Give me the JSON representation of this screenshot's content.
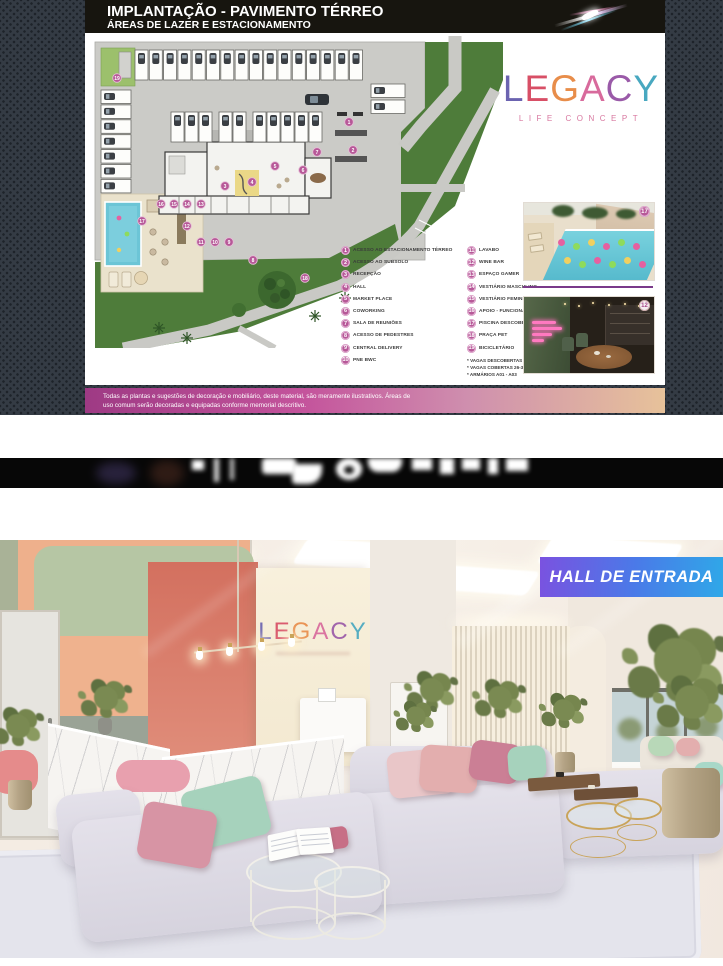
{
  "header": {
    "title_line1": "IMPLANTAÇÃO - PAVIMENTO TÉRREO",
    "title_line2": "ÁREAS DE LAZER E ESTACIONAMENTO"
  },
  "brand": {
    "name": "LEGACY",
    "tagline": "LIFE CONCEPT",
    "letters": [
      {
        "ch": "L",
        "color": "#6b63b0"
      },
      {
        "ch": "E",
        "color": "#d84f66"
      },
      {
        "ch": "G",
        "color": "#e88d4a"
      },
      {
        "ch": "A",
        "color": "#d86a9c"
      },
      {
        "ch": "C",
        "color": "#9a5aa8"
      },
      {
        "ch": "Y",
        "color": "#48a8c0"
      }
    ]
  },
  "legend": {
    "column1": [
      {
        "num": "1",
        "label": "ACESSO AO ESTACIONAMENTO TÉRREO"
      },
      {
        "num": "2",
        "label": "ACESSO AO SUBSOLO"
      },
      {
        "num": "3",
        "label": "RECEPÇÃO"
      },
      {
        "num": "4",
        "label": "HALL"
      },
      {
        "num": "5",
        "label": "MARKET PLACE"
      },
      {
        "num": "6",
        "label": "COWORKING"
      },
      {
        "num": "7",
        "label": "SALA DE REUNIÕES"
      },
      {
        "num": "8",
        "label": "ACESSO DE PEDESTRES"
      },
      {
        "num": "9",
        "label": "CENTRAL DELIVERY"
      },
      {
        "num": "10",
        "label": "PNE BWC"
      }
    ],
    "column2": [
      {
        "num": "11",
        "label": "LAVABO"
      },
      {
        "num": "12",
        "label": "WINE BAR"
      },
      {
        "num": "13",
        "label": "ESPAÇO GAMER"
      },
      {
        "num": "14",
        "label": "VESTIÁRIO MASCULINO"
      },
      {
        "num": "15",
        "label": "VESTIÁRIO FEMININO"
      },
      {
        "num": "16",
        "label": "APOIO - FUNCIONÁRIO"
      },
      {
        "num": "17",
        "label": "PISCINA DESCOBERTA"
      },
      {
        "num": "18",
        "label": "PRAÇA PET"
      },
      {
        "num": "19",
        "label": "BICICLETÁRIO"
      }
    ],
    "footnotes": [
      "* VAGAS DESCOBERTAS 1-25",
      "* VAGAS COBERTAS 26-35",
      "* ARMÁRIOS A01 - A03"
    ]
  },
  "map_badges": [
    {
      "n": "1",
      "x": 260,
      "y": 86
    },
    {
      "n": "2",
      "x": 264,
      "y": 114
    },
    {
      "n": "3",
      "x": 136,
      "y": 150
    },
    {
      "n": "4",
      "x": 163,
      "y": 146
    },
    {
      "n": "5",
      "x": 186,
      "y": 130
    },
    {
      "n": "6",
      "x": 214,
      "y": 134
    },
    {
      "n": "7",
      "x": 228,
      "y": 116
    },
    {
      "n": "8",
      "x": 164,
      "y": 224
    },
    {
      "n": "9",
      "x": 140,
      "y": 206
    },
    {
      "n": "10",
      "x": 126,
      "y": 206
    },
    {
      "n": "11",
      "x": 112,
      "y": 206
    },
    {
      "n": "12",
      "x": 98,
      "y": 190
    },
    {
      "n": "13",
      "x": 112,
      "y": 168
    },
    {
      "n": "14",
      "x": 98,
      "y": 168
    },
    {
      "n": "15",
      "x": 85,
      "y": 168
    },
    {
      "n": "16",
      "x": 72,
      "y": 168
    },
    {
      "n": "17",
      "x": 53,
      "y": 185
    },
    {
      "n": "18",
      "x": 216,
      "y": 242
    },
    {
      "n": "19",
      "x": 28,
      "y": 42
    }
  ],
  "thumbnails": [
    {
      "badge": "17",
      "name": "piscina-descoberta-render"
    },
    {
      "badge": "12",
      "name": "wine-bar-render"
    }
  ],
  "disclaimer": "Todas as plantas e sugestões de decoração e mobiliário, deste material, são meramente ilustrativos. Áreas de uso comum serão decoradas e equipadas conforme memorial descritivo.",
  "hall": {
    "badge": "HALL DE ENTRADA"
  },
  "colors": {
    "legend_badge_pink": "#b75898",
    "hall_badge_gradient": [
      "#7a52e0",
      "#2fa8e8"
    ],
    "disclaimer_gradient": [
      "#9e3a84",
      "#e7c29a"
    ],
    "pool_blue": "#6cc5d6",
    "lawn_green": "#4e7c3a",
    "paving_gray": "#cbcbc7"
  }
}
